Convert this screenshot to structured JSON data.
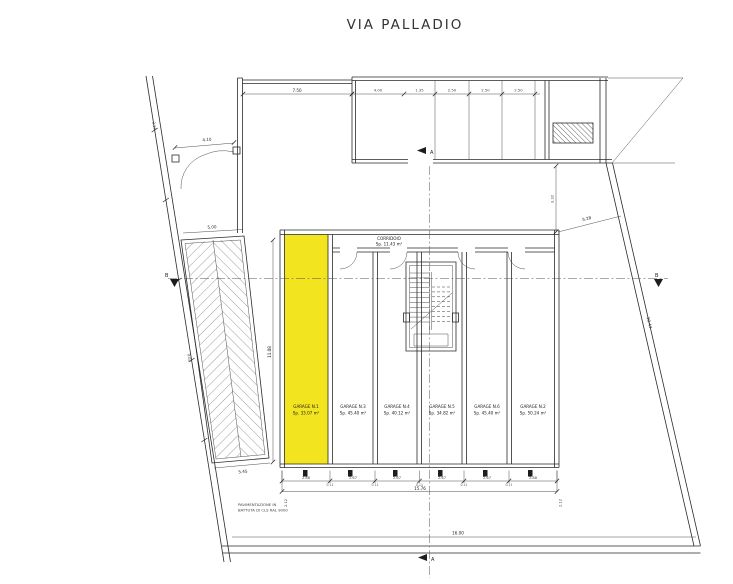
{
  "title": "VIA PALLADIO",
  "corridor": {
    "name": "CORRIDOIO",
    "area": "Sp. 11.43 m²"
  },
  "garages": [
    {
      "name": "GARAGE N.1",
      "area": "Sp. 33.07 m²",
      "highlighted": true
    },
    {
      "name": "GARAGE N.3",
      "area": "Sp. 45.40 m²",
      "highlighted": false
    },
    {
      "name": "GARAGE N.4",
      "area": "Sp. 40.12 m²",
      "highlighted": false
    },
    {
      "name": "GARAGE N.5",
      "area": "Sp. 34.82 m²",
      "highlighted": false
    },
    {
      "name": "GARAGE N.6",
      "area": "Sp. 45.40 m²",
      "highlighted": false
    },
    {
      "name": "GARAGE N.2",
      "area": "Sp. 50.24 m²",
      "highlighted": false
    }
  ],
  "notes": {
    "paving_line1": "PAVIMENTAZIONE IN",
    "paving_line2": "BATTUTA DI CLS RAL 9000"
  },
  "section_markers": {
    "top": "A",
    "bottom": "A",
    "left": "B",
    "right": "B"
  },
  "dimensions": {
    "top_bays": [
      "4.00",
      "1.35",
      "2.50",
      "2.50",
      "2.50"
    ],
    "gate_width": "4.10",
    "wall_offset": "7.50",
    "ramp_top": "5.00",
    "ramp_bottom": "5.45",
    "stall_widths": [
      "2.88",
      "2.67",
      "2.67",
      "2.67",
      "2.67",
      "2.88"
    ],
    "wall_thickness": [
      "0.11",
      "0.11",
      "0.11",
      "0.11",
      "0.11"
    ],
    "block_total": "15.76",
    "site_bottom": "16.00",
    "right_diagonal": "5.28",
    "right_boundary": "10.44",
    "left_boundary_upper": "2.17",
    "left_boundary_lower": "9.07",
    "block_left_height": "11.08",
    "right_zone_height": "3.32",
    "block_side_left": "2.12",
    "block_side_right": "2.12"
  },
  "colors": {
    "highlight": "#F2E41F",
    "line": "#2A2A2A"
  }
}
